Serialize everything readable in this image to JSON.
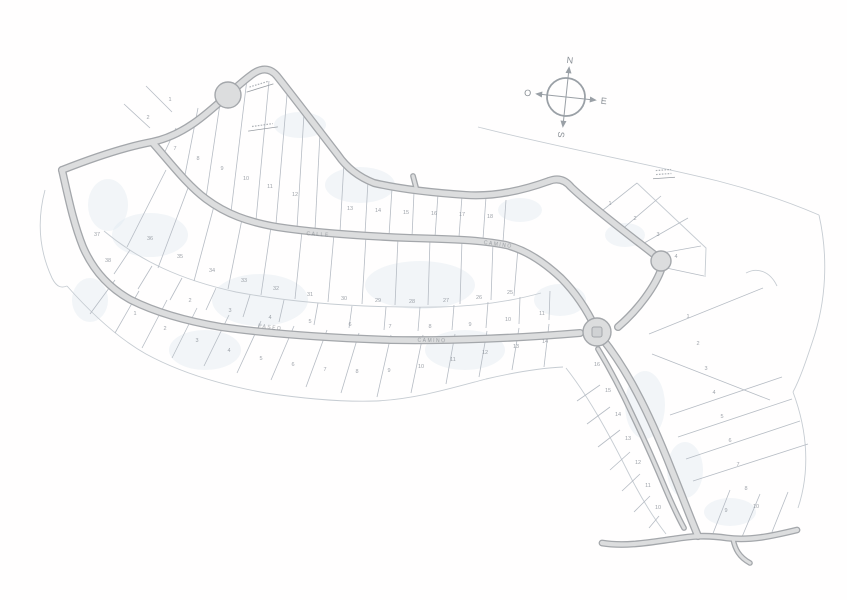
{
  "compass": {
    "n": "N",
    "s": "S",
    "e": "E",
    "w": "O"
  },
  "map": {
    "bg": "#fffefe",
    "road_casing": "#a4a7ab",
    "road_fill": "#dcddde",
    "lot_line": "#b6bcc4",
    "boundary": "#c6ccd2",
    "number_color": "#8d939b",
    "label_color": "#82878d",
    "tint_color": "#dde7f0",
    "roads": [
      {
        "name": "top-road",
        "d": "M62,170 C95,157 125,147 152,142 C195,133 222,97 250,76 Q266,63 277,76 C296,100 321,133 338,155 Q351,174 374,183 C404,190 436,193 466,195 C497,197 527,189 549,181",
        "w": 5.5
      },
      {
        "name": "northeast-road",
        "d": "M549,181 Q562,176 571,187 C594,209 637,241 656,256",
        "w": 5.5
      },
      {
        "name": "northeast-road-lower",
        "d": "M662,267 C656,286 637,311 618,327",
        "w": 5.5
      },
      {
        "name": "arc-road",
        "d": "M152,142 C169,161 186,184 206,199 C226,214 248,222 277,227 C316,233 361,236 410,238 C451,239 481,240 506,245 C526,250 545,263 561,278 C576,293 588,312 596,329",
        "w": 5.5
      },
      {
        "name": "west-south-road",
        "d": "M62,170 C68,196 73,222 83,247 C93,270 109,288 131,300 C157,313 186,321 221,327 C271,334 331,338 391,340 C451,341 521,338 580,333",
        "w": 5.5
      },
      {
        "name": "southeast-road",
        "d": "M601,337 C613,352 625,370 636,391 C650,417 661,443 672,471 C681,493 690,517 698,536",
        "w": 5.5
      },
      {
        "name": "southeast-parallel-road",
        "d": "M598,349 C610,369 622,392 633,416 C645,441 656,466 666,490 C672,504 678,517 684,528",
        "w": 3.2
      },
      {
        "name": "bottom-road",
        "d": "M602,543 C626,547 652,542 674,539 C692,536 707,535 727,538 C750,541 772,536 797,530",
        "w": 4.2
      },
      {
        "name": "bottom-stub-road",
        "d": "M733,539 C735,549 739,557 750,563",
        "w": 3.0
      },
      {
        "name": "north-stub-road",
        "d": "M413,176 L417,191",
        "w": 3.2
      }
    ],
    "circles": [
      {
        "name": "culdesac-bulb",
        "cx": 228,
        "cy": 95,
        "r": 13
      },
      {
        "name": "knuckle",
        "cx": 661,
        "cy": 261,
        "r": 10
      },
      {
        "name": "roundabout",
        "cx": 597,
        "cy": 332,
        "r": 14
      }
    ],
    "island": {
      "x": 592,
      "y": 327,
      "w": 10,
      "h": 10
    },
    "lot_lines": [
      [
        176,
        128,
        162,
        158
      ],
      [
        198,
        108,
        184,
        180
      ],
      [
        222,
        90,
        206,
        198
      ],
      [
        247,
        79,
        231,
        212
      ],
      [
        269,
        81,
        256,
        220
      ],
      [
        287,
        95,
        276,
        224
      ],
      [
        304,
        114,
        297,
        228
      ],
      [
        320,
        133,
        315,
        230
      ],
      [
        344,
        162,
        340,
        232
      ],
      [
        368,
        181,
        365,
        234
      ],
      [
        392,
        188,
        389,
        236
      ],
      [
        414,
        192,
        412,
        237
      ],
      [
        438,
        194,
        435,
        237
      ],
      [
        462,
        196,
        459,
        237
      ],
      [
        486,
        197,
        483,
        239
      ],
      [
        506,
        200,
        503,
        242
      ],
      [
        150,
        128,
        124,
        104
      ],
      [
        172,
        112,
        146,
        86
      ],
      [
        598,
        214,
        637,
        183
      ],
      [
        620,
        231,
        661,
        196
      ],
      [
        639,
        246,
        688,
        218
      ],
      [
        651,
        255,
        701,
        246
      ],
      [
        657,
        266,
        704,
        276
      ],
      [
        166,
        170,
        127,
        247
      ],
      [
        188,
        188,
        158,
        268
      ],
      [
        214,
        206,
        194,
        281
      ],
      [
        242,
        219,
        228,
        289
      ],
      [
        271,
        227,
        261,
        295
      ],
      [
        302,
        231,
        295,
        299
      ],
      [
        334,
        234,
        328,
        302
      ],
      [
        366,
        236,
        362,
        304
      ],
      [
        398,
        238,
        395,
        305
      ],
      [
        430,
        239,
        428,
        305
      ],
      [
        462,
        240,
        460,
        304
      ],
      [
        493,
        242,
        491,
        300
      ],
      [
        518,
        248,
        514,
        296
      ],
      [
        130,
        250,
        114,
        274
      ],
      [
        152,
        266,
        138,
        289
      ],
      [
        182,
        278,
        170,
        300
      ],
      [
        216,
        288,
        206,
        310
      ],
      [
        250,
        295,
        243,
        317
      ],
      [
        284,
        300,
        279,
        322
      ],
      [
        318,
        303,
        314,
        325
      ],
      [
        352,
        306,
        349,
        328
      ],
      [
        386,
        307,
        384,
        330
      ],
      [
        420,
        307,
        418,
        331
      ],
      [
        454,
        305,
        452,
        330
      ],
      [
        488,
        302,
        486,
        328
      ],
      [
        520,
        297,
        519,
        324
      ],
      [
        550,
        291,
        549,
        320
      ],
      [
        115,
        280,
        90,
        314
      ],
      [
        139,
        291,
        115,
        333
      ],
      [
        167,
        300,
        142,
        348
      ],
      [
        197,
        308,
        172,
        358
      ],
      [
        229,
        315,
        204,
        366
      ],
      [
        261,
        321,
        237,
        373
      ],
      [
        294,
        326,
        271,
        380
      ],
      [
        327,
        330,
        306,
        387
      ],
      [
        359,
        333,
        341,
        393
      ],
      [
        391,
        335,
        377,
        397
      ],
      [
        423,
        335,
        411,
        393
      ],
      [
        455,
        334,
        446,
        384
      ],
      [
        487,
        331,
        479,
        377
      ],
      [
        519,
        328,
        512,
        370
      ],
      [
        549,
        324,
        544,
        367
      ],
      [
        649,
        334,
        763,
        288
      ],
      [
        652,
        354,
        770,
        400
      ],
      [
        670,
        415,
        782,
        377
      ],
      [
        678,
        437,
        792,
        399
      ],
      [
        686,
        459,
        800,
        421
      ],
      [
        693,
        481,
        808,
        444
      ],
      [
        600,
        385,
        577,
        401
      ],
      [
        610,
        407,
        587,
        424
      ],
      [
        620,
        430,
        598,
        447
      ],
      [
        630,
        452,
        610,
        470
      ],
      [
        640,
        474,
        622,
        491
      ],
      [
        650,
        496,
        634,
        512
      ],
      [
        659,
        516,
        649,
        528
      ],
      [
        712,
        536,
        730,
        490
      ],
      [
        742,
        537,
        760,
        494
      ],
      [
        772,
        532,
        788,
        492
      ]
    ],
    "boundary_paths": [
      "M478,127 C560,148 645,163 718,181 C757,191 791,203 819,215",
      "M819,215 C828,255 827,300 812,343 C806,361 800,379 793,392",
      "M67,286 C90,312 116,337 146,354 C181,373 221,385 266,393 C306,399 346,402 376,401 C416,399 452,388 486,379 C516,372 541,368 563,367",
      "M45,190 C37,220 39,250 52,278 C57,288 62,288 67,286",
      "M104,231 C140,261 181,280 236,292 C300,304 370,308 440,307 C481,306 516,300 541,293",
      "M566,368 C588,396 608,432 628,472 C640,496 652,516 666,534",
      "M746,273 C757,267 770,271 777,286",
      "M637,183 L706,248 L705,277",
      "M793,392 C808,432 810,472 798,508"
    ],
    "tint_blobs": [
      [
        150,
        235,
        38,
        22
      ],
      [
        260,
        300,
        48,
        26
      ],
      [
        420,
        285,
        55,
        24
      ],
      [
        360,
        185,
        35,
        18
      ],
      [
        560,
        300,
        26,
        16
      ],
      [
        645,
        405,
        20,
        34
      ],
      [
        685,
        470,
        18,
        28
      ],
      [
        205,
        350,
        36,
        20
      ],
      [
        465,
        350,
        40,
        20
      ],
      [
        300,
        125,
        26,
        13
      ],
      [
        108,
        205,
        20,
        26
      ],
      [
        625,
        235,
        20,
        12
      ],
      [
        730,
        512,
        26,
        14
      ],
      [
        90,
        300,
        18,
        22
      ],
      [
        520,
        210,
        22,
        12
      ]
    ],
    "lot_numbers": [
      [
        175,
        150,
        "7"
      ],
      [
        198,
        160,
        "8"
      ],
      [
        222,
        170,
        "9"
      ],
      [
        246,
        180,
        "10"
      ],
      [
        270,
        188,
        "11"
      ],
      [
        295,
        196,
        "12"
      ],
      [
        350,
        210,
        "13"
      ],
      [
        378,
        212,
        "14"
      ],
      [
        406,
        214,
        "15"
      ],
      [
        434,
        215,
        "16"
      ],
      [
        462,
        216,
        "17"
      ],
      [
        490,
        218,
        "18"
      ],
      [
        610,
        205,
        "1"
      ],
      [
        635,
        220,
        "2"
      ],
      [
        658,
        236,
        "3"
      ],
      [
        676,
        258,
        "4"
      ],
      [
        150,
        240,
        "36"
      ],
      [
        180,
        258,
        "35"
      ],
      [
        212,
        272,
        "34"
      ],
      [
        244,
        282,
        "33"
      ],
      [
        276,
        290,
        "32"
      ],
      [
        310,
        296,
        "31"
      ],
      [
        344,
        300,
        "30"
      ],
      [
        378,
        302,
        "29"
      ],
      [
        412,
        303,
        "28"
      ],
      [
        446,
        302,
        "27"
      ],
      [
        479,
        299,
        "26"
      ],
      [
        510,
        294,
        "25"
      ],
      [
        190,
        302,
        "2"
      ],
      [
        230,
        312,
        "3"
      ],
      [
        270,
        319,
        "4"
      ],
      [
        310,
        323,
        "5"
      ],
      [
        350,
        326,
        "6"
      ],
      [
        390,
        328,
        "7"
      ],
      [
        430,
        328,
        "8"
      ],
      [
        470,
        326,
        "9"
      ],
      [
        508,
        321,
        "10"
      ],
      [
        542,
        315,
        "11"
      ],
      [
        135,
        315,
        "1"
      ],
      [
        165,
        330,
        "2"
      ],
      [
        197,
        342,
        "3"
      ],
      [
        229,
        352,
        "4"
      ],
      [
        261,
        360,
        "5"
      ],
      [
        293,
        366,
        "6"
      ],
      [
        325,
        371,
        "7"
      ],
      [
        357,
        373,
        "8"
      ],
      [
        389,
        372,
        "9"
      ],
      [
        421,
        368,
        "10"
      ],
      [
        453,
        361,
        "11"
      ],
      [
        485,
        354,
        "12"
      ],
      [
        516,
        348,
        "13"
      ],
      [
        545,
        343,
        "14"
      ],
      [
        97,
        236,
        "37"
      ],
      [
        108,
        262,
        "38"
      ],
      [
        688,
        318,
        "1"
      ],
      [
        698,
        345,
        "2"
      ],
      [
        706,
        370,
        "3"
      ],
      [
        714,
        394,
        "4"
      ],
      [
        722,
        418,
        "5"
      ],
      [
        730,
        442,
        "6"
      ],
      [
        738,
        466,
        "7"
      ],
      [
        746,
        490,
        "8"
      ],
      [
        597,
        366,
        "16"
      ],
      [
        608,
        392,
        "15"
      ],
      [
        618,
        416,
        "14"
      ],
      [
        628,
        440,
        "13"
      ],
      [
        638,
        464,
        "12"
      ],
      [
        648,
        487,
        "11"
      ],
      [
        658,
        509,
        "10"
      ],
      [
        726,
        512,
        "9"
      ],
      [
        756,
        508,
        "10"
      ],
      [
        148,
        119,
        "2"
      ],
      [
        170,
        101,
        "1"
      ]
    ],
    "street_labels": [
      {
        "text": "CALLE",
        "x": 318,
        "y": 236,
        "rot": 4
      },
      {
        "text": "CAMINO",
        "x": 498,
        "y": 246,
        "rot": 8
      },
      {
        "text": "PASEO",
        "x": 270,
        "y": 329,
        "rot": 7
      },
      {
        "text": "CAMINO",
        "x": 432,
        "y": 342,
        "rot": 1
      }
    ],
    "annotations": [
      {
        "x": 263,
        "y": 129,
        "len": 30,
        "rot": -8,
        "rows": 1
      },
      {
        "x": 664,
        "y": 178,
        "len": 22,
        "rot": -4,
        "rows": 2
      },
      {
        "x": 260,
        "y": 88,
        "len": 28,
        "rot": -17,
        "rows": 1
      }
    ]
  }
}
